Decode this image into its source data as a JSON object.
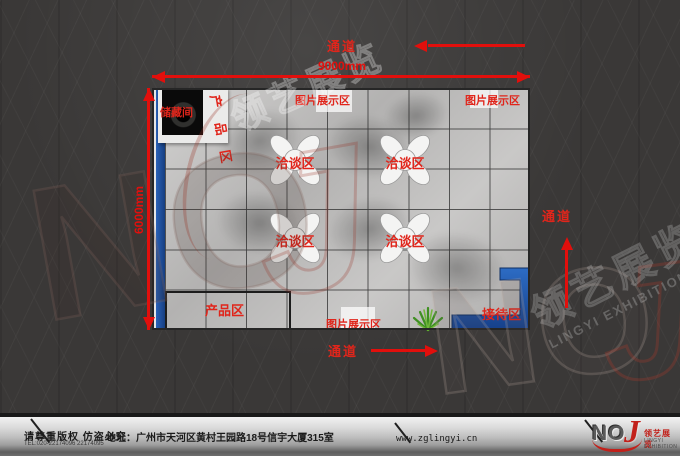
{
  "plan": {
    "width_label": "9000mm",
    "height_label": "6000mm",
    "storage_label": "储藏间",
    "product_area_top_label": "产品区",
    "product_area_bottom_label": "产品区",
    "picture_labels": [
      "图片展示区",
      "图片展示区",
      "图片展示区"
    ],
    "negotiation_labels": [
      "洽谈区",
      "洽谈区",
      "洽谈区",
      "洽谈区"
    ],
    "reception_label": "接待区"
  },
  "aisles": {
    "top": "通道",
    "right": "通道",
    "bottom": "通道"
  },
  "footer": {
    "copyright": "请尊重版权 仿盗必究",
    "tel": "TEL:020-22174096 22174095",
    "address": "地址：广州市天河区黄村王园路18号信宇大厦315室",
    "website": "www.zglingyi.cn",
    "logo_no": "NO",
    "logo_j": "J",
    "brand_cn": "领艺展览",
    "brand_en": "LINGYI EXHIBITION"
  },
  "watermarks": {
    "noj_no": "NO",
    "noj_j": "J",
    "brand_cn": "领艺展览",
    "brand_en": "LINGYI EXHIBITION"
  },
  "colors": {
    "accent_red": "#e20f0c",
    "desk_blue": "#1d4f9c",
    "tile_gray": "#bdbcbb",
    "background": "#3a3837"
  }
}
